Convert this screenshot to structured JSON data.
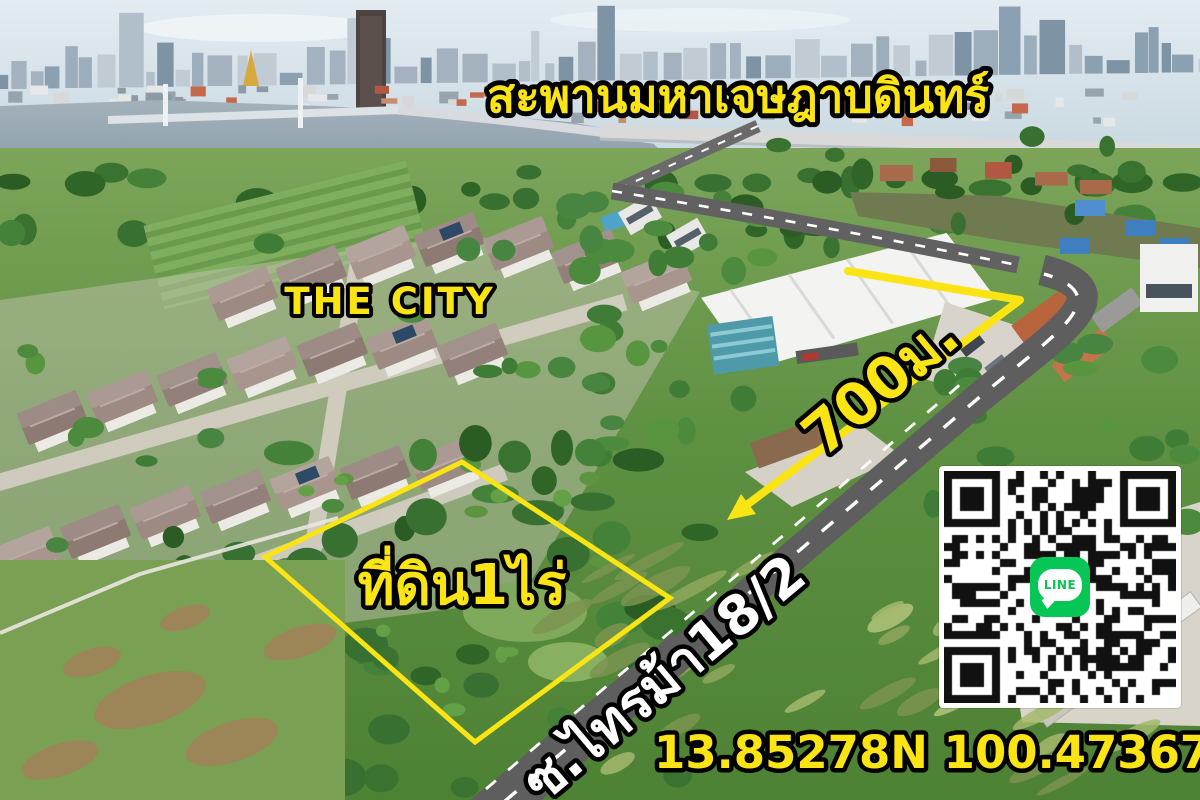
{
  "scene": {
    "description": "Aerial drone photograph advertising a 1-rai land plot next to a housing estate, with river, bridge and city skyline in the background"
  },
  "labels": {
    "bridge_name": "สะพานมหาเจษฎาบดินทร์",
    "estate_name": "THE CITY",
    "distance": "700ม.",
    "plot_area": "ที่ดิน1ไร่",
    "road_name": "ซ.ไทรม้า18/2",
    "coordinates": "13.85278N 100.47367E"
  },
  "qr": {
    "logo_label": "LINE",
    "brand_color": "#06C755"
  },
  "colors": {
    "annotation_yellow": "#fae414",
    "road_label_white": "#ffffff",
    "outline_black": "#000000",
    "road_gray": "#616161"
  }
}
